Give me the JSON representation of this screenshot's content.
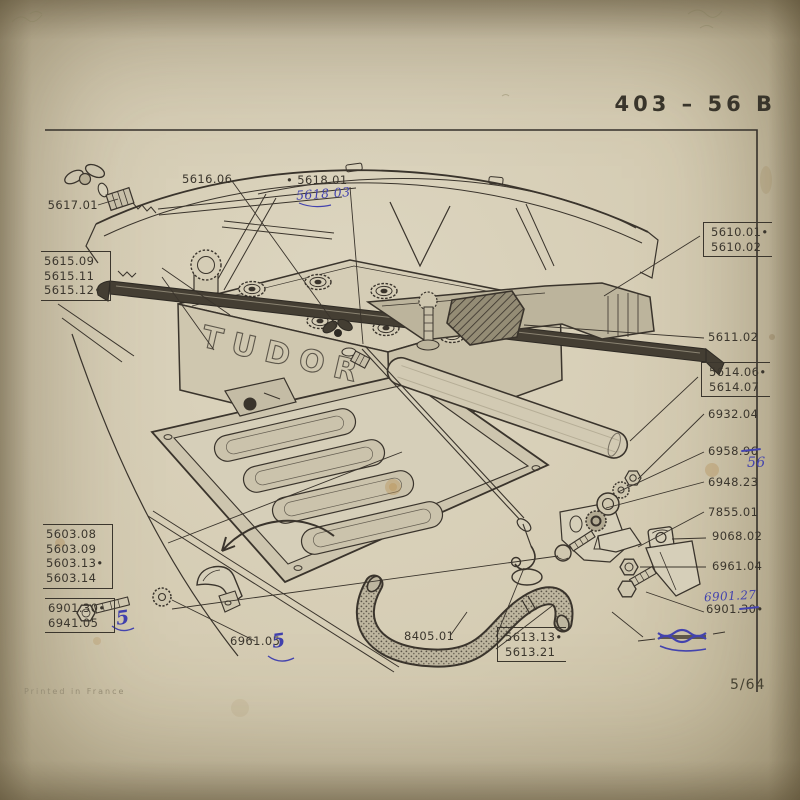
{
  "page": {
    "plate_number": "403 – 56 B",
    "printed_in": "Printed in France",
    "page_number": "5/64",
    "battery_brand": "TUDOR"
  },
  "labels": {
    "wing_bolt": "5617.01",
    "clamp_screw": "5616.06",
    "rod_top": "• 5618.01",
    "rod_top_handwritten": "5618 03",
    "clamp_frame": [
      "5615.09",
      "5615.11",
      "5615.12•"
    ],
    "support": [
      "5610.01•",
      "5610.02"
    ],
    "pad": "5611.02",
    "bar": [
      "5614.06•",
      "5614.07"
    ],
    "nut_6932": "6932.04",
    "washer_6958_prefix": "6958.",
    "washer_6958_struck": "96",
    "washer_6958_handwritten": "56",
    "grommet_6948": "6948.23",
    "bracket_7855": "7855.01",
    "clipnut_9068": "9068.02",
    "nut_6961": "6961.04",
    "bolt_6901_handwritten": "6901.27",
    "bolt_6901_prefix": "6901.",
    "bolt_6901_struck": "30",
    "bolt_6901_bullet": "•",
    "tray": [
      "5603.08",
      "5603.09",
      "5603.13•",
      "5603.14"
    ],
    "tray_bolt": [
      "6901.30•",
      "6941.05"
    ],
    "tray_bolt_handwritten": "5",
    "clip_screw": "6961.05",
    "clip_screw_handwritten": "5",
    "hose": "8405.01",
    "rod": [
      "5613.13•",
      "5613.21"
    ]
  }
}
